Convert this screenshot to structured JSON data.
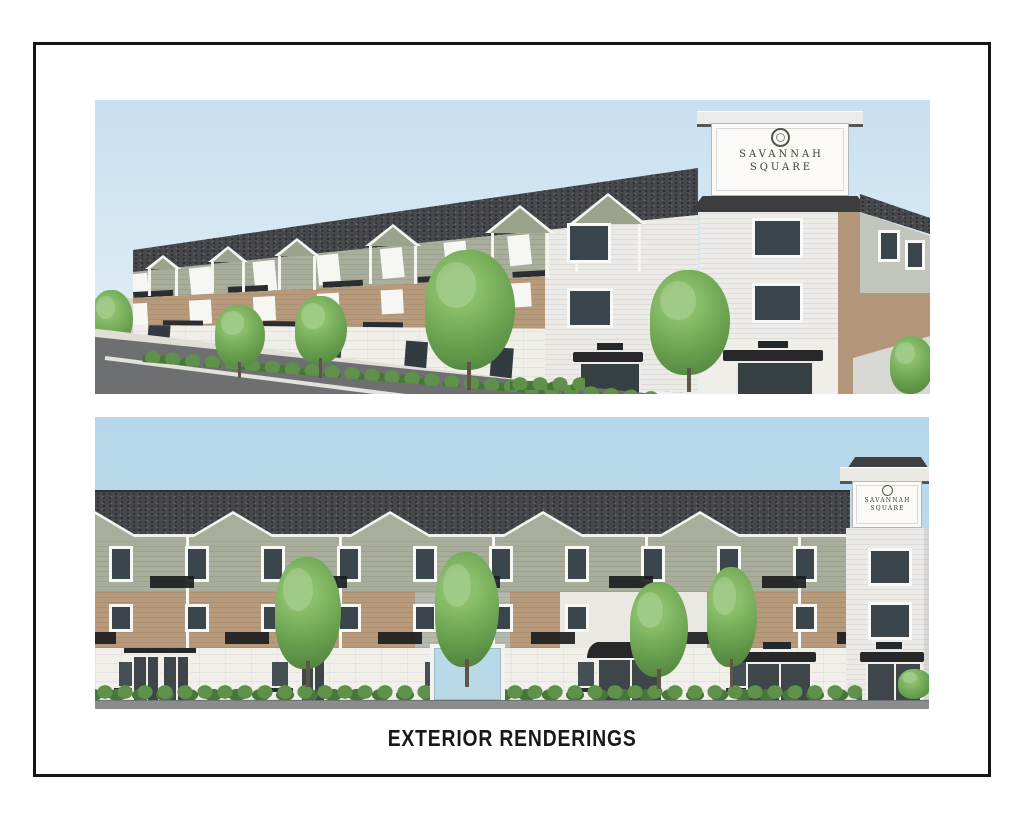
{
  "caption": "EXTERIOR RENDERINGS",
  "signs": {
    "top": {
      "line1": "SAVANNAH",
      "line2": "SQUARE"
    },
    "bottom": {
      "line1": "SAVANNAH",
      "line2": "SQUARE"
    }
  },
  "colors": {
    "frame_black": "#151515",
    "sky_top": "#c8dff0",
    "sky_bottom": "#b5d7e9",
    "roof_charcoal": "#47484b",
    "siding_sage": "#a9ae9c",
    "siding_gray": "#b5b9ad",
    "brick_tan": "#b69a7b",
    "wall_white": "#f0efe9",
    "trim_white": "#f6f6f3",
    "window_dark": "#39444b",
    "awning_black": "#26282a",
    "sign_white": "#fbfaf7",
    "foliage_green": "#6aa24f",
    "road_dark": "#6e6f71",
    "road_light": "#8b8c8e",
    "caption_text": "#191919"
  }
}
